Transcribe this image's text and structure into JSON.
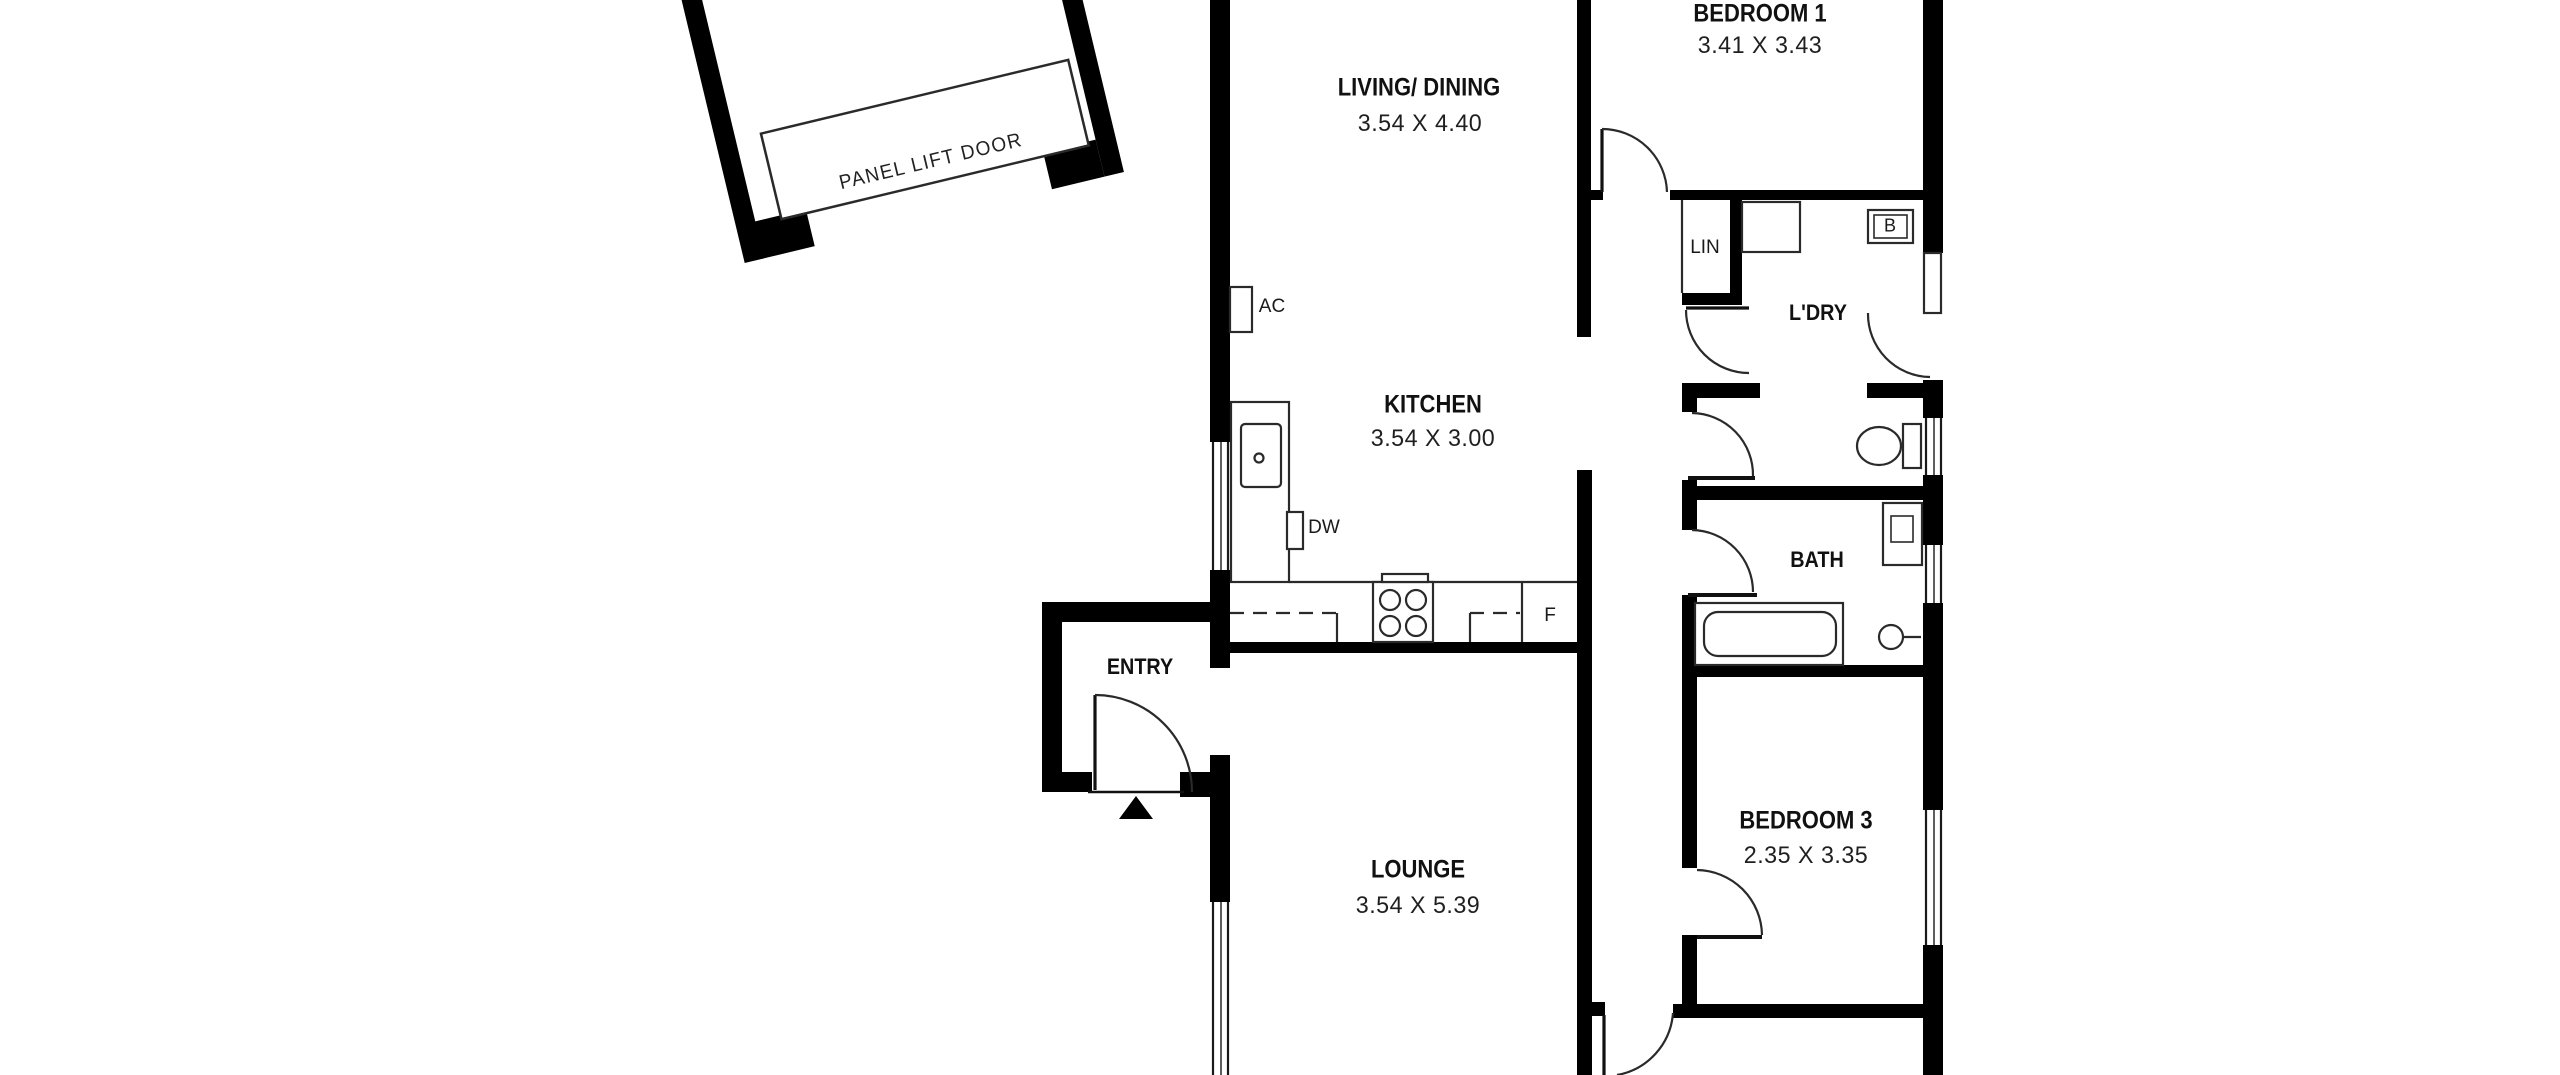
{
  "rooms": [
    {
      "name": "LIVING/ DINING",
      "dims": "3.54 X 4.40"
    },
    {
      "name": "KITCHEN",
      "dims": "3.54 X 3.00"
    },
    {
      "name": "LOUNGE",
      "dims": "3.54 X 5.39"
    },
    {
      "name": "BEDROOM 1",
      "dims": "3.41 X 3.43"
    },
    {
      "name": "BEDROOM 3",
      "dims": "2.35 X 3.35"
    },
    {
      "name": "ENTRY"
    },
    {
      "name": "L'DRY"
    },
    {
      "name": "BATH"
    }
  ],
  "fixtures": {
    "linen": "LIN",
    "b_unit": "B",
    "air_conditioner": "AC",
    "dishwasher": "DW",
    "fridge": "F"
  },
  "garage": {
    "door_label": "PANEL LIFT DOOR"
  },
  "colors": {
    "wall": "#000000",
    "line": "#2a2a2a",
    "background": "#ffffff"
  }
}
